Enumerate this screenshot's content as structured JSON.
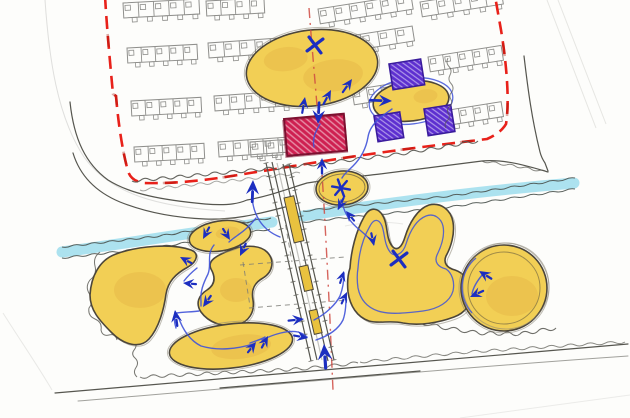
{
  "meta": {
    "title": "Hand-drawn landscape masterplan sketch",
    "description": "Concept site plan sketch: housing estate with red dashed boundary, stream, yellow open-space blobs, purple and red hatched plots, central avenue and blue movement arrows",
    "canvas": {
      "width": 630,
      "height": 418
    }
  },
  "palette": {
    "paper": "#fdfdfb",
    "faint_line": "#c2c2bf",
    "sketch_line": "#56564f",
    "housing_line": "#8f8f8c",
    "vegetation": "#55554f",
    "boundary_red": "#e8211a",
    "centerline_red": "#cf4a42",
    "stream_fill": "#a5dfee",
    "stream_edge": "#4a524e",
    "meadow_yellow": "#f2cf55",
    "meadow_shade": "#dfa53c",
    "blob_outline": "#4c463a",
    "building_red_fill": "#ce2051",
    "building_red_outline": "#7d1030",
    "plot_purple_fill": "#5d2fd0",
    "plot_purple_outline": "#3a1c9c",
    "annotation_blue": "#1c2ec0",
    "flow_blue": "#3f52d8"
  },
  "elements": [
    {
      "name": "housing-blocks",
      "desc": "rows of terraced building footprints",
      "color": "#8f8f8c"
    },
    {
      "name": "site-boundary",
      "desc": "red dashed boundary line",
      "color": "#e8211a"
    },
    {
      "name": "central-axis",
      "desc": "red dash-dot centreline",
      "color": "#cf4a42"
    },
    {
      "name": "stream",
      "desc": "light blue water channel",
      "color": "#a5dfee"
    },
    {
      "name": "meadow-blobs",
      "desc": "yellow organic open-space areas",
      "count": 9,
      "color": "#f2cf55"
    },
    {
      "name": "purple-plots",
      "desc": "purple hatched plot rectangles",
      "count": 3,
      "color": "#5d2fd0"
    },
    {
      "name": "red-building",
      "desc": "crimson hatched building rectangle",
      "count": 1,
      "color": "#ce2051"
    },
    {
      "name": "avenue",
      "desc": "central avenue with yellow median strips",
      "count": 3
    },
    {
      "name": "movement-arrows",
      "desc": "blue sketched arrows",
      "count": 26,
      "color": "#1c2ec0"
    },
    {
      "name": "x-marks",
      "desc": "blue X marks",
      "count": 2
    },
    {
      "name": "asterisk-marks",
      "desc": "blue asterisk node",
      "count": 1
    }
  ],
  "housing_rows": [
    [
      123,
      3,
      -3,
      76,
      5
    ],
    [
      206,
      1,
      -3,
      58,
      4
    ],
    [
      127,
      48,
      -3,
      70,
      5
    ],
    [
      208,
      43,
      -4,
      78,
      5
    ],
    [
      131,
      101,
      -3,
      70,
      5
    ],
    [
      214,
      96,
      -4,
      76,
      5
    ],
    [
      134,
      147,
      -3,
      70,
      5
    ],
    [
      218,
      142,
      -4,
      75,
      5
    ],
    [
      318,
      9,
      -9,
      94,
      6
    ],
    [
      420,
      2,
      -9,
      82,
      5
    ],
    [
      343,
      37,
      -9,
      70,
      4
    ],
    [
      428,
      57,
      -9,
      74,
      5
    ],
    [
      352,
      90,
      -9,
      58,
      4
    ],
    [
      430,
      113,
      -9,
      72,
      5
    ],
    [
      250,
      142,
      -4,
      32,
      2
    ]
  ],
  "squiggles": [
    {
      "pts": [
        [
          132,
          181
        ],
        [
          210,
          174
        ],
        [
          300,
          166
        ],
        [
          400,
          154
        ],
        [
          478,
          141
        ]
      ],
      "amp": 3,
      "wl": 9,
      "w": 1.1,
      "c": "vegetation",
      "o": 0.9
    },
    {
      "pts": [
        [
          140,
          190
        ],
        [
          220,
          182
        ],
        [
          300,
          173
        ]
      ],
      "amp": 2.5,
      "wl": 8,
      "w": 1,
      "c": "vegetation",
      "o": 0.5
    },
    {
      "pts": [
        [
          62,
          247
        ],
        [
          160,
          236
        ],
        [
          271,
          218
        ]
      ],
      "amp": 1.6,
      "wl": 9,
      "w": 1,
      "c": "stream_edge",
      "o": 0.9
    },
    {
      "pts": [
        [
          62,
          258
        ],
        [
          160,
          247
        ],
        [
          270,
          229
        ]
      ],
      "amp": 1.6,
      "wl": 9,
      "w": 1,
      "c": "stream_edge",
      "o": 0.9
    },
    {
      "pts": [
        [
          303,
          211
        ],
        [
          450,
          196
        ],
        [
          575,
          178
        ]
      ],
      "amp": 1.6,
      "wl": 10,
      "w": 1,
      "c": "stream_edge",
      "o": 0.9
    },
    {
      "pts": [
        [
          303,
          222
        ],
        [
          450,
          207
        ],
        [
          575,
          189
        ]
      ],
      "amp": 1.6,
      "wl": 10,
      "w": 1,
      "c": "stream_edge",
      "o": 0.9
    },
    {
      "pts": [
        [
          100,
          252
        ],
        [
          90,
          280
        ],
        [
          89,
          308
        ],
        [
          101,
          330
        ],
        [
          117,
          340
        ]
      ],
      "amp": 5,
      "wl": 12,
      "w": 1,
      "c": "vegetation",
      "o": 0.8
    },
    {
      "pts": [
        [
          107,
          262
        ],
        [
          100,
          288
        ],
        [
          103,
          312
        ]
      ],
      "amp": 4,
      "wl": 10,
      "w": 1,
      "c": "vegetation",
      "o": 0.45
    },
    {
      "pts": [
        [
          133,
          333
        ],
        [
          135,
          358
        ],
        [
          137,
          377
        ]
      ],
      "amp": 4,
      "wl": 9,
      "w": 1,
      "c": "vegetation",
      "o": 0.8
    },
    {
      "pts": [
        [
          140,
          377
        ],
        [
          220,
          373
        ],
        [
          300,
          369
        ],
        [
          358,
          363
        ]
      ],
      "amp": 3,
      "wl": 9,
      "w": 1,
      "c": "vegetation",
      "o": 0.8
    },
    {
      "pts": [
        [
          402,
          318
        ],
        [
          440,
          327
        ],
        [
          478,
          333
        ],
        [
          520,
          334
        ],
        [
          556,
          328
        ]
      ],
      "amp": 3.5,
      "wl": 9,
      "w": 1,
      "c": "vegetation",
      "o": 0.85
    },
    {
      "pts": [
        [
          360,
          362
        ],
        [
          470,
          352
        ],
        [
          575,
          345
        ],
        [
          625,
          342
        ]
      ],
      "amp": 2.5,
      "wl": 10,
      "w": 1,
      "c": "vegetation",
      "o": 0.7
    },
    {
      "pts": [
        [
          448,
          58
        ],
        [
          452,
          92
        ],
        [
          446,
          128
        ]
      ],
      "amp": 3,
      "wl": 8,
      "w": 1,
      "c": "vegetation",
      "o": 0.7
    },
    {
      "pts": [
        [
          482,
          161
        ],
        [
          515,
          166
        ],
        [
          547,
          172
        ]
      ],
      "amp": 2,
      "wl": 8,
      "w": 1,
      "c": "vegetation",
      "o": 0.7
    }
  ],
  "ticks": [
    {
      "x1": 266,
      "y1": 163,
      "x2": 311,
      "y2": 361,
      "n": 15,
      "len": 5
    },
    {
      "x1": 289,
      "y1": 164,
      "x2": 334,
      "y2": 360,
      "n": 15,
      "len": 5
    }
  ],
  "annotations": {
    "arrows": [
      {
        "x": 352,
        "y": 79,
        "r": 35,
        "stem": 7,
        "s": 1
      },
      {
        "x": 331,
        "y": 90,
        "r": 28,
        "stem": 7,
        "s": 1
      },
      {
        "x": 305,
        "y": 97,
        "r": 10,
        "stem": 7,
        "s": 1
      },
      {
        "x": 318,
        "y": 124,
        "r": 183,
        "stem": 10,
        "s": 1.25
      },
      {
        "x": 392,
        "y": 101,
        "r": 92,
        "stem": 11,
        "s": 1.2
      },
      {
        "x": 322,
        "y": 158,
        "r": 0,
        "stem": 6,
        "s": 1.05
      },
      {
        "x": 338,
        "y": 210,
        "r": 205,
        "stem": 4,
        "s": 1
      },
      {
        "x": 346,
        "y": 211,
        "r": -40,
        "stem": 4,
        "s": 0.95
      },
      {
        "x": 374,
        "y": 246,
        "r": 168,
        "stem": 4,
        "s": 1
      },
      {
        "x": 479,
        "y": 271,
        "r": -58,
        "stem": 5,
        "s": 1.05
      },
      {
        "x": 470,
        "y": 297,
        "r": 245,
        "stem": 5,
        "s": 1.05
      },
      {
        "x": 344,
        "y": 271,
        "r": 18,
        "stem": 4,
        "s": 0.95
      },
      {
        "x": 347,
        "y": 292,
        "r": 25,
        "stem": 4,
        "s": 0.95
      },
      {
        "x": 308,
        "y": 338,
        "r": 100,
        "stem": 5,
        "s": 1
      },
      {
        "x": 304,
        "y": 319,
        "r": 84,
        "stem": 6,
        "s": 1.05
      },
      {
        "x": 324,
        "y": 344,
        "r": -4,
        "stem": 11,
        "s": 1.45
      },
      {
        "x": 253,
        "y": 180,
        "r": 2,
        "stem": 10,
        "s": 1.3
      },
      {
        "x": 203,
        "y": 239,
        "r": 208,
        "stem": 4,
        "s": 1
      },
      {
        "x": 230,
        "y": 240,
        "r": 148,
        "stem": 4,
        "s": 1
      },
      {
        "x": 240,
        "y": 256,
        "r": 205,
        "stem": 4,
        "s": 1.05
      },
      {
        "x": 203,
        "y": 307,
        "r": 215,
        "stem": 4,
        "s": 1.05
      },
      {
        "x": 180,
        "y": 257,
        "r": -62,
        "stem": 4,
        "s": 1
      },
      {
        "x": 183,
        "y": 283,
        "r": -85,
        "stem": 4,
        "s": 1
      },
      {
        "x": 175,
        "y": 310,
        "r": -8,
        "stem": 6,
        "s": 1.1
      },
      {
        "x": 256,
        "y": 342,
        "r": 38,
        "stem": 4,
        "s": 1
      },
      {
        "x": 268,
        "y": 336,
        "r": 28,
        "stem": 4,
        "s": 1
      }
    ],
    "x_marks": [
      {
        "x": 315,
        "y": 45
      },
      {
        "x": 399,
        "y": 259
      }
    ],
    "asterisks": [
      {
        "x": 341,
        "y": 188
      }
    ],
    "flow_paths": [
      "M320,124 C316,131 312,138 314,147",
      "M392,109 C379,118 370,125 368,137 C366,149 361,158 353,166 C348,171 344,174 342,178",
      "M341,200 C340,204 339,207 338,209",
      "M342,202 C345,216 352,224 361,231 C368,237 372,241 374,244",
      "M314,320 C326,314 336,304 340,296 C343,288 344,280 344,273",
      "M316,340 C328,336 338,330 343,320 C346,312 346,302 346,294",
      "M262,340 C274,334 288,330 298,332 C302,333 305,335 307,337",
      "M214,245 C206,255 212,264 208,274 C203,284 200,292 201,301 L201,306",
      "M199,311 C191,312 183,312 177,313",
      "M176,328 C174,322 174,317 175,312",
      "M178,316 C183,331 191,341 201,346 C218,351 237,349 253,344",
      "M250,343 C256,341 262,339 265,337",
      "M256,218 C250,226 244,231 238,235 C234,238 231,240 229,242",
      "M253,186 C251,198 253,210 259,220 C264,228 272,234 280,237",
      "M197,268 C192,272 187,277 184,281",
      "M483,274 C477,281 473,288 472,294"
    ]
  }
}
